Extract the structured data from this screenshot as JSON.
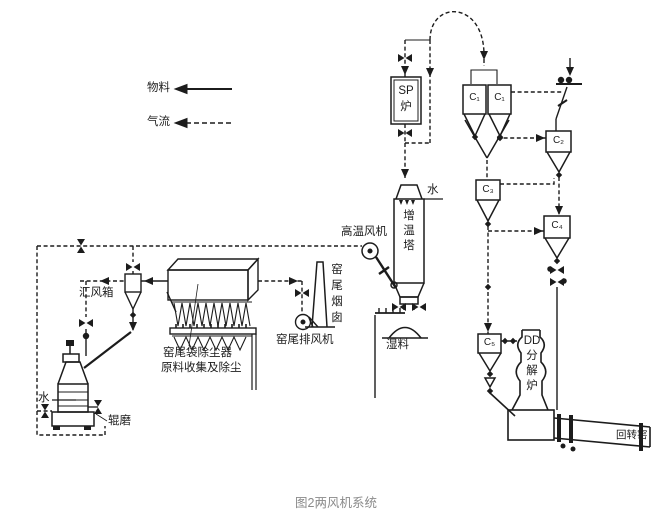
{
  "caption": "图2两风机系统",
  "legend": {
    "material": "物料",
    "airflow": "气流"
  },
  "components": {
    "sp_furnace": "SP\n炉",
    "cyclone_c1a": "C₁",
    "cyclone_c1b": "C₁",
    "cyclone_c2": "C₂",
    "cyclone_c3": "C₃",
    "cyclone_c4": "C₄",
    "cyclone_c5": "C₅",
    "dd_calciner": "DD\n分\n解\n炉",
    "rotary_kiln": "回转窑",
    "conditioning_tower": "增\n温\n塔",
    "tower_water": "水",
    "high_temp_fan": "高温风机",
    "wet_material": "湿料",
    "kiln_tail_chimney": "窑\n尾\n烟\n囱",
    "kiln_tail_exhaust_fan": "窑尾排风机",
    "bag_dust_collector": "窑尾袋除尘器",
    "raw_material_note": "原料收集及除尘",
    "air_collecting_box": "汇风箱",
    "roller_mill": "辊磨",
    "mill_water": "水"
  },
  "colors": {
    "line": "#1c1c1c",
    "caption": "#8a8a8a",
    "bg": "#ffffff"
  }
}
